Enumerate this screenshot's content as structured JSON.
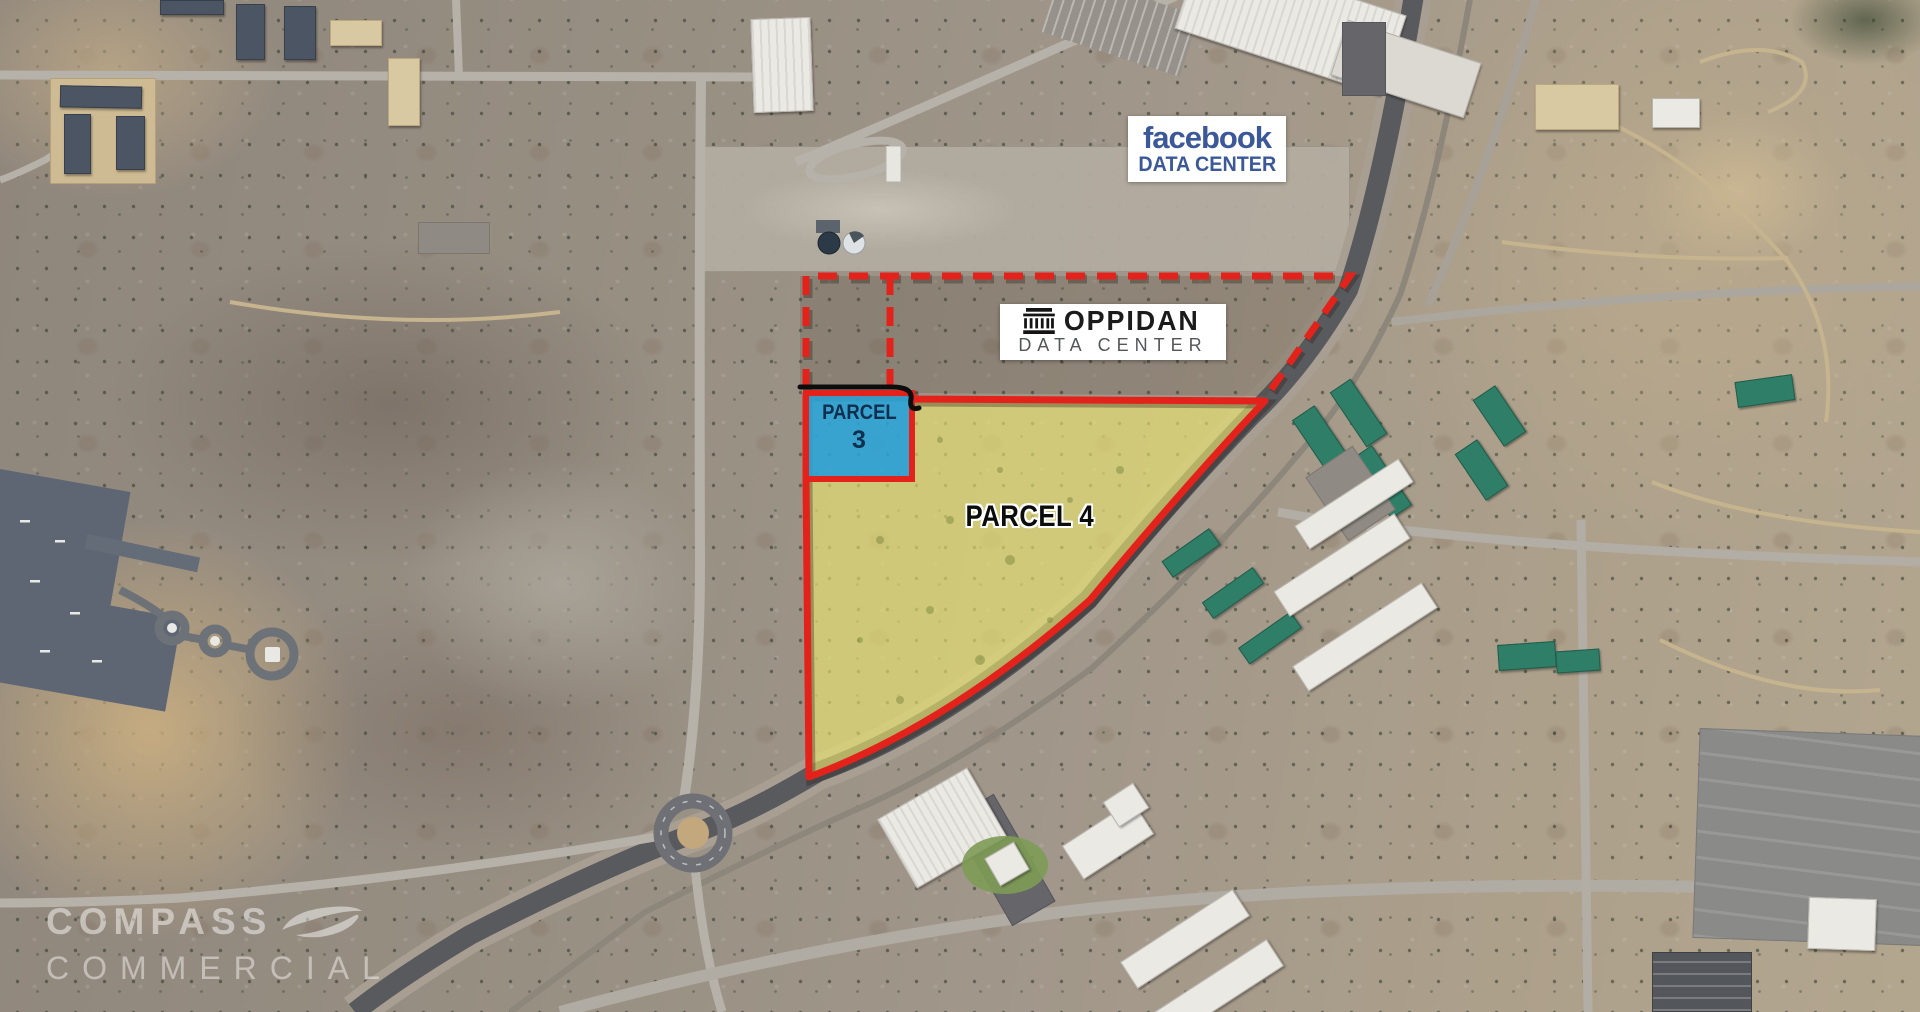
{
  "annotations": {
    "facebook_label": {
      "brand": "facebook",
      "subtitle": "DATA CENTER"
    },
    "oppidan_label": {
      "brand": "OPPIDAN",
      "subtitle": "DATA CENTER"
    },
    "parcel_3": {
      "title": "PARCEL",
      "number": "3"
    },
    "parcel_4": {
      "title": "PARCEL 4"
    },
    "watermark": {
      "brand": "COMPASS",
      "subtitle": "COMMERCIAL"
    }
  },
  "colors": {
    "boundary_red": "#e3231b",
    "parcel_3_fill": "#28a6dd",
    "parcel_3_text": "#0e2f4e",
    "parcel_4_fill": "#eee870",
    "facebook_blue": "#3b5998",
    "oppidan_text": "#1b1b1b",
    "oppidan_subtitle_gray": "#55565a"
  }
}
